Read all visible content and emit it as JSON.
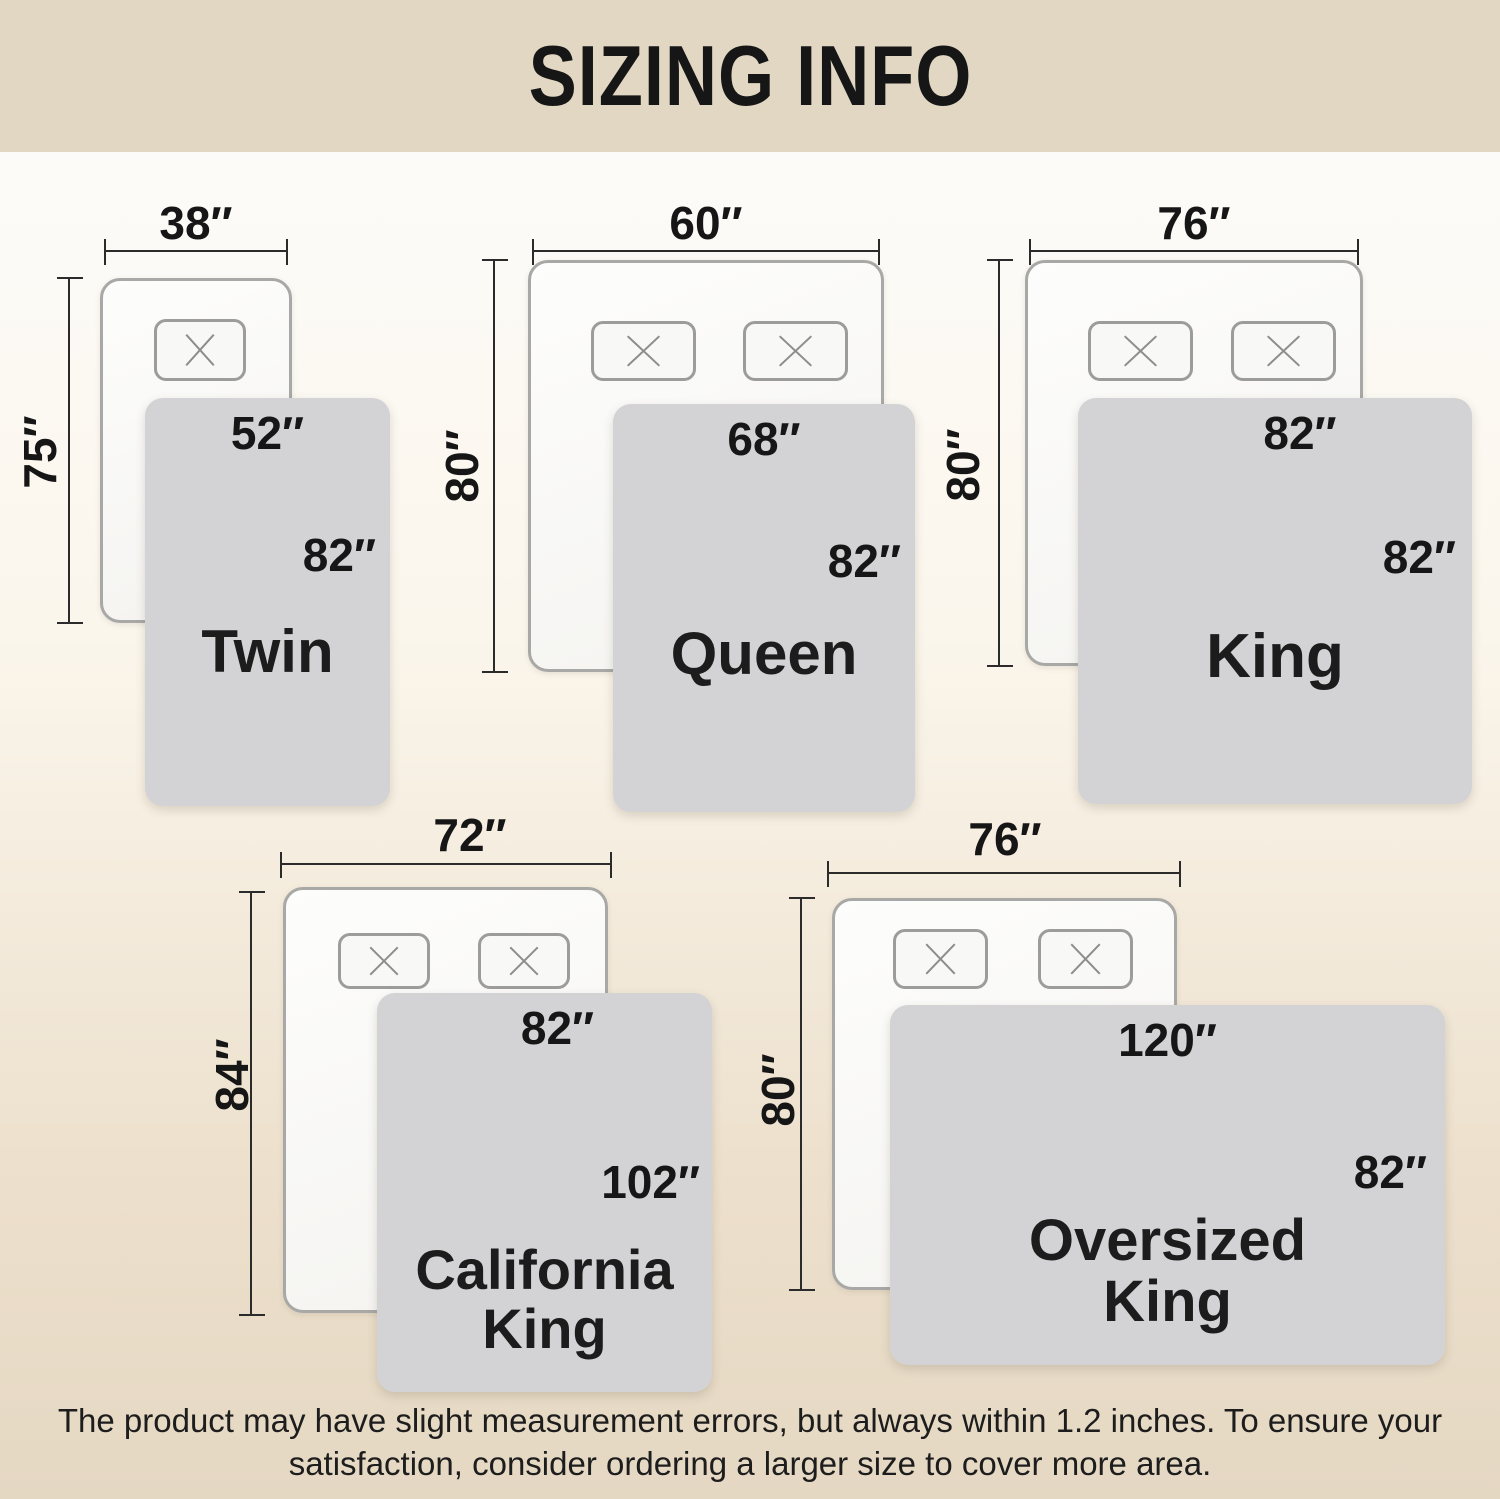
{
  "header": {
    "title": "SIZING INFO"
  },
  "sizes": [
    {
      "name": "Twin",
      "mattress_width": "38″",
      "mattress_length": "75″",
      "blanket_width": "52″",
      "blanket_length": "82″",
      "pillows": 1
    },
    {
      "name": "Queen",
      "mattress_width": "60″",
      "mattress_length": "80″",
      "blanket_width": "68″",
      "blanket_length": "82″",
      "pillows": 2
    },
    {
      "name": "King",
      "mattress_width": "76″",
      "mattress_length": "80″",
      "blanket_width": "82″",
      "blanket_length": "82″",
      "pillows": 2
    },
    {
      "name": "California King",
      "mattress_width": "72″",
      "mattress_length": "84″",
      "blanket_width": "82″",
      "blanket_length": "102″",
      "pillows": 2
    },
    {
      "name": "Oversized King",
      "mattress_width": "76″",
      "mattress_length": "80″",
      "blanket_width": "120″",
      "blanket_length": "82″",
      "pillows": 2
    }
  ],
  "footer": {
    "note": "The product may have slight measurement errors, but always within 1.2 inches. To ensure your satisfaction, consider ordering a larger size to cover more area."
  },
  "colors": {
    "header_bg": "#e2d7c3",
    "blanket": "#d3d3d5",
    "mattress_border": "#a8a8a6",
    "pillow_border": "#9c9c9a",
    "pillow_x": "#8d8d8b",
    "dim": "#2b2b2b",
    "text": "#161616"
  }
}
